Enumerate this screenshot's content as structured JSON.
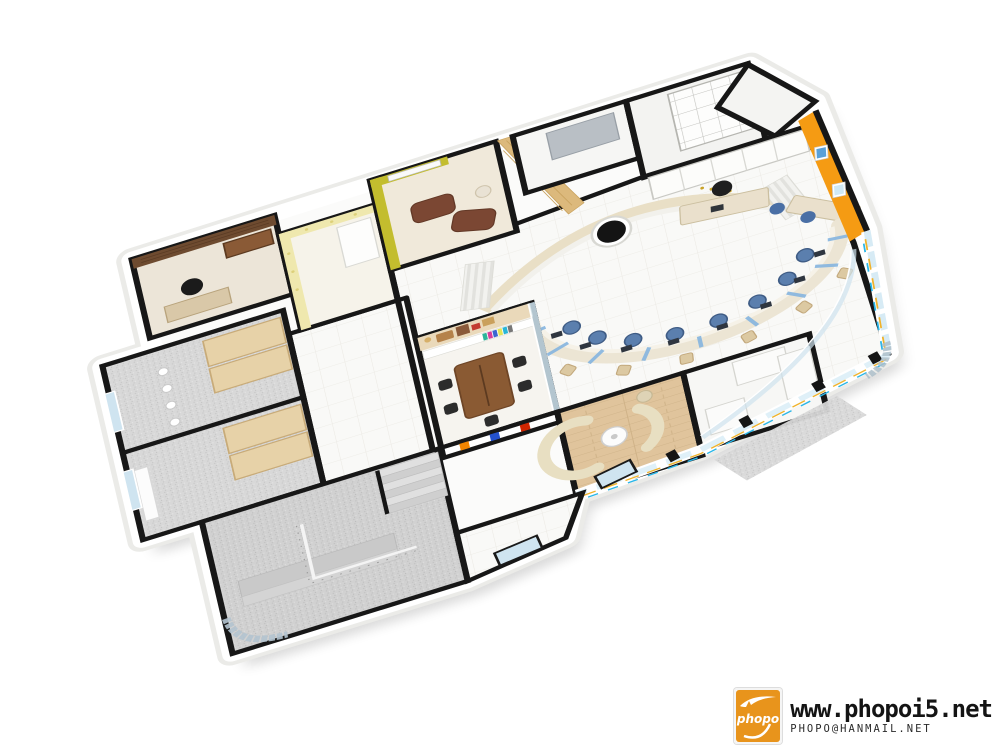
{
  "watermark": {
    "site_url": "www.phopoi5.net",
    "email": "PHOPO@HANMAIL.NET",
    "logo_text": "phopo"
  },
  "palette": {
    "logo_orange": "#e8941c",
    "wall_cap_black": "#171717",
    "orange_feature_wall": "#f59b13",
    "vip_wall_yellow": "#c3bd2e",
    "gold_panel_wall": "#dcb97c",
    "marble_feature_wall": "#e9dfc6",
    "leather_sofa_brown": "#7b4733",
    "teller_counter_beige": "#ece5d4",
    "teller_divider_blue": "#85b5e0",
    "staff_chair_blue": "#5b7fae",
    "client_chair_beige": "#dcc9a2",
    "lounge_sofa_cream": "#e8dfc2",
    "meeting_table_wood": "#8a5a33",
    "exec_wall_wood": "#6e4b30",
    "niche_orange": "#f08400",
    "niche_blue": "#2451cc",
    "niche_red": "#cf2500",
    "facade_stripe_yellow": "#f0b22a",
    "facade_stripe_cyan": "#29b6e8",
    "glass_blue": "#cfe4f0"
  }
}
